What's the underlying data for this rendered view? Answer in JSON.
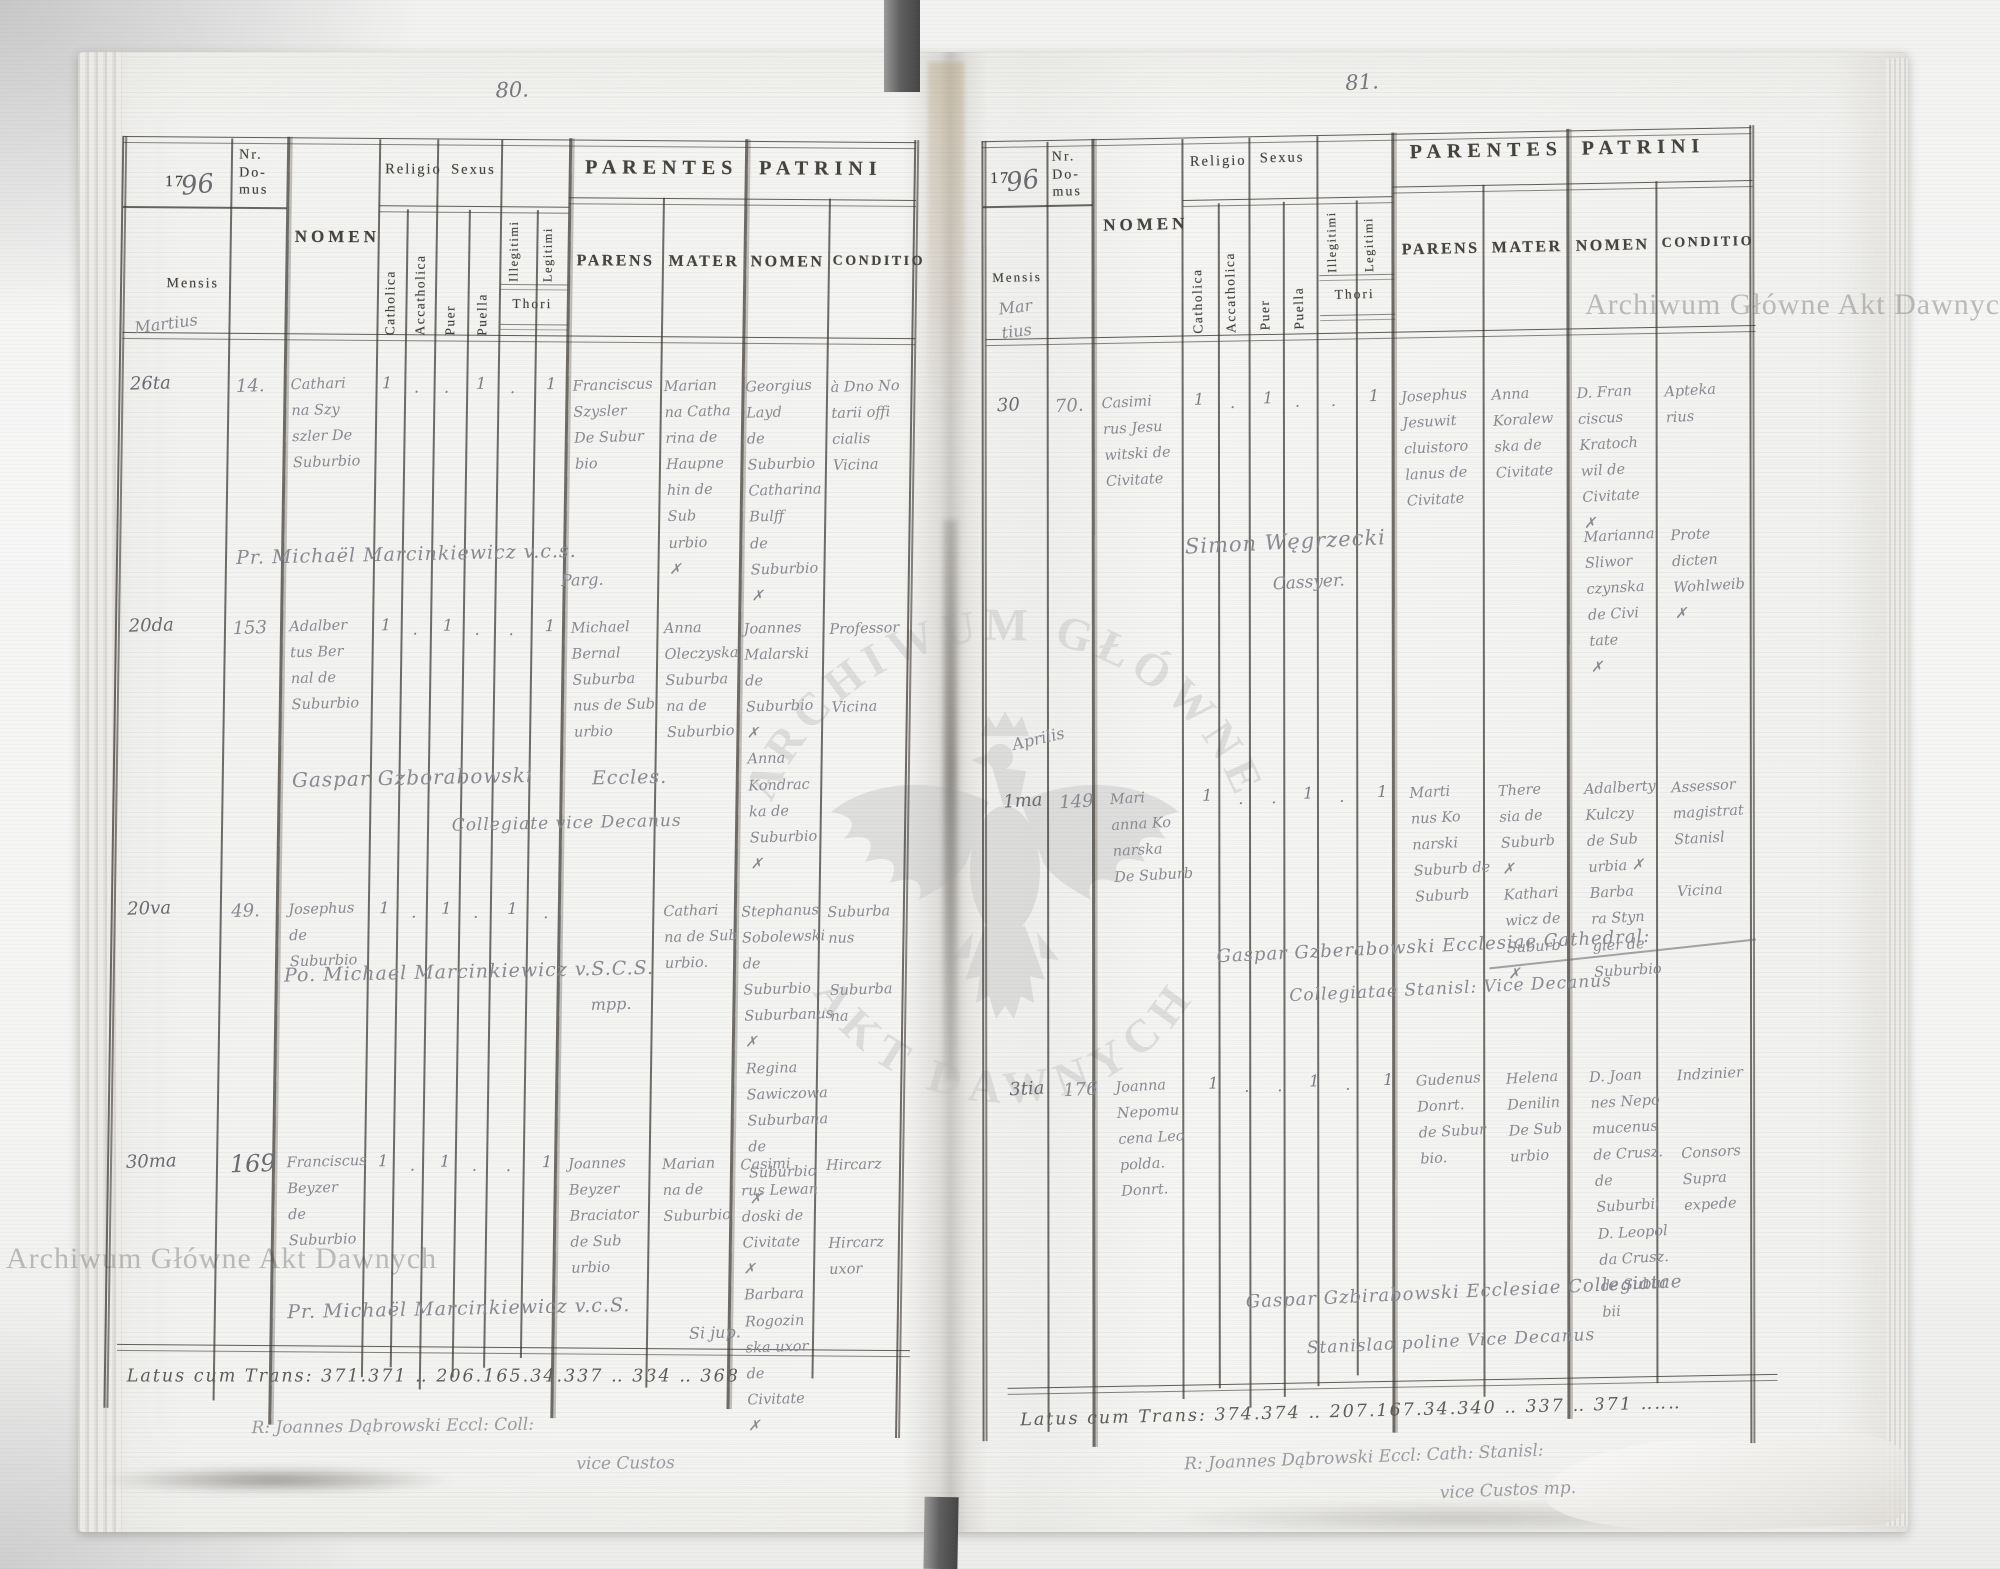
{
  "doc": {
    "watermarks": {
      "archive_name": "Archiwum Główne Akt Dawnych",
      "seal_top": "ARCHIWUM GŁÓWNE",
      "seal_bottom": "AKT DAWNYCH"
    },
    "headers": {
      "year_printed": "17",
      "year_hand": "96",
      "nr_domus": "Nr.\nDo-\nmus",
      "mensis": "Mensis",
      "nomen": "NOMEN",
      "religio": "Religio",
      "sexus": "Sexus",
      "catholica": "Catholica",
      "accatholica": "Accatholica",
      "puer": "Puer",
      "puella": "Puella",
      "illegitimi": "Illegitimi",
      "legitimi": "Legitimi",
      "thori": "Thori",
      "parentes": "PARENTES",
      "parens": "PARENS",
      "mater": "MATER",
      "patrini": "PATRINI",
      "patrini_nomen": "NOMEN",
      "conditio": "CONDITIO"
    },
    "pages": [
      {
        "page_number": "80.",
        "month_label": "Martius",
        "records": [
          {
            "date": "26ta",
            "nr": "14.",
            "nomen": "Cathari\nna Szy\nszler De\nSuburbio",
            "marks": [
              "1",
              ".",
              ".",
              "1",
              ".",
              "1"
            ],
            "parens": "Franciscus\nSzysler\nDe Subur\nbio",
            "mater": "Marian\nna Catha\nrina de\nHaupne\nhin de Sub\nurbio\n✗",
            "patrini": "Georgius\nLayd\nde Suburbio\nCatharina\nBulff\nde Suburbio\n✗",
            "conditio": "à Dno No\ntarii offi\ncialis\nVicina"
          },
          {
            "date": "20da",
            "nr": "153",
            "nomen": "Adalber\ntus Ber\nnal de\nSuburbio",
            "marks": [
              "1",
              ".",
              "1",
              ".",
              ".",
              "1"
            ],
            "parens": "Michael\nBernal\nSuburba\nnus de Sub\nurbio",
            "mater": "Anna\nOleczyska\nSuburba\nna de\nSuburbio",
            "patrini": "Joannes\nMalarski\nde Suburbio\n✗\nAnna\nKondrac\nka de\nSuburbio\n✗",
            "conditio": "Professor\n\n\nVicina"
          },
          {
            "date": "20va",
            "nr": "49.",
            "nomen": "Josephus\nde Suburbio",
            "marks": [
              "1",
              ".",
              "1",
              ".",
              "1",
              "."
            ],
            "parens": "",
            "mater": "Cathari\nna de Sub\nurbio.",
            "patrini": "Stephanus\nSobolewski\nde Suburbio\nSuburbanus\n✗\nRegina\nSawiczowa\nSuburbana\nde Suburbio\n✗",
            "conditio": "Suburba\nnus\n\nSuburba\nna"
          },
          {
            "date": "30ma",
            "nr": "169",
            "nomen": "Franciscus\nBeyzer\nde Suburbio",
            "marks": [
              "1",
              ".",
              "1",
              ".",
              ".",
              "1"
            ],
            "parens": "Joannes\nBeyzer\nBraciator\nde Sub\nurbio",
            "mater": "Marian\nna de\nSuburbio",
            "patrini": "Casimi\nrus Lewan\ndoski de\nCivitate\n✗\nBarbara\nRogozin\nska uxor\nde Civitate\n✗",
            "conditio": "Hircarz\n\n\nHircarz\nuxor"
          }
        ],
        "annotations": {
          "sig_r1": "Pr. Michaël Marcinkiewicz v.c.s.",
          "sig_r1b": "Parg.",
          "sig_r2a": "Gaspar Gzborabowski",
          "sig_r2b": "Eccles.",
          "sig_r2c": "Collegiate vice Decanus",
          "sig_r3a": "Po. Michael Marcinkiewicz v.S.C.S.",
          "sig_r3b": "mpp.",
          "sig_r4a": "Pr. Michaël Marcinkiewicz v.c.S.",
          "sig_r4b": "Si jup."
        },
        "latus_line": "Latus cum Trans: 371.371 ‥ 206.165.34.337 ‥ 334 ‥ 368",
        "clerk_signature": "R: Joannes Dąbrowski Eccl: Coll:",
        "clerk_signature2": "vice Custos"
      },
      {
        "page_number": "81.",
        "month_label": "Mar\ntius",
        "month_label2": "Aprilis",
        "records": [
          {
            "date": "30",
            "nr": "70.",
            "nomen": "Casimi\nrus Jesu\nwitski de\nCivitate",
            "marks": [
              "1",
              ".",
              "1",
              ".",
              ".",
              "1"
            ],
            "parens": "Josephus\nJesuwit\ncluistoro\nlanus de\nCivitate",
            "mater": "Anna\nKoralew\nska de\nCivitate",
            "patrini": "D. Fran\nciscus\nKratoch\nwil de\nCivitate\n✗",
            "conditio": "Apteka\nrius",
            "patrini_b": "Marianna\nSliwor\nczynska\nde Civi\ntate\n✗",
            "conditio_b": "Prote\ndicten\nWohlweib\n✗"
          },
          {
            "date": "1ma",
            "nr": "149",
            "nomen": "Mari\nanna Ko\nnarska\nDe Suburb",
            "marks": [
              "1",
              ".",
              ".",
              "1",
              ".",
              "1"
            ],
            "parens": "Marti\nnus Ko\nnarski\nSuburb de\nSuburb",
            "mater": "There\nsia de\nSuburb\n✗\nKathari\nwicz de\nSuburb\n✗",
            "patrini": "Adalberty\nKulczy\nde Sub\nurbia ✗\nBarba\nra Styn\ngier de\nSuburbio",
            "conditio": "Assessor\nmagistrat\nStanisl\n\nVicina"
          },
          {
            "date": "3tia",
            "nr": "176",
            "nomen": "Joanna\nNepomu\ncena Leo\npolda.\nDonrt.",
            "marks": [
              "1",
              ".",
              ".",
              "1",
              ".",
              "1"
            ],
            "parens": "Gudenus\nDonrt.\nde Subur\nbio.",
            "mater": "Helena\nDenilin\nDe Sub\nurbio",
            "patrini": "D. Joan\nnes Nepo\nmucenus\nde Crusz.\nde Suburbii\nD. Leopol\nda Crusz.\nde Subur\nbii",
            "conditio": "Indzinier\n\n\nConsors\nSupra\nexpede"
          }
        ],
        "annotations": {
          "sig_r1": "Simon Węgrzecki",
          "sig_r1b": "Cassyer.",
          "sig_r2a": "Gaspar Gzberabowski Ecclesiae Cathedral:",
          "sig_r2b": "Collegiatae Stanisl: Vice Decanus",
          "sig_r3a": "Gaspar Gzbirabowski Ecclesiae Collegiatae",
          "sig_r3b": "Stanislao poline Vice Decanus"
        },
        "latus_line": "Latus cum Trans: 374.374 ‥ 207.167.34.340 ‥ 337 ‥ 371 ‥‥‥",
        "clerk_signature": "R: Joannes Dąbrowski Eccl: Cath: Stanisl:",
        "clerk_signature2": "vice Custos mp."
      }
    ]
  }
}
